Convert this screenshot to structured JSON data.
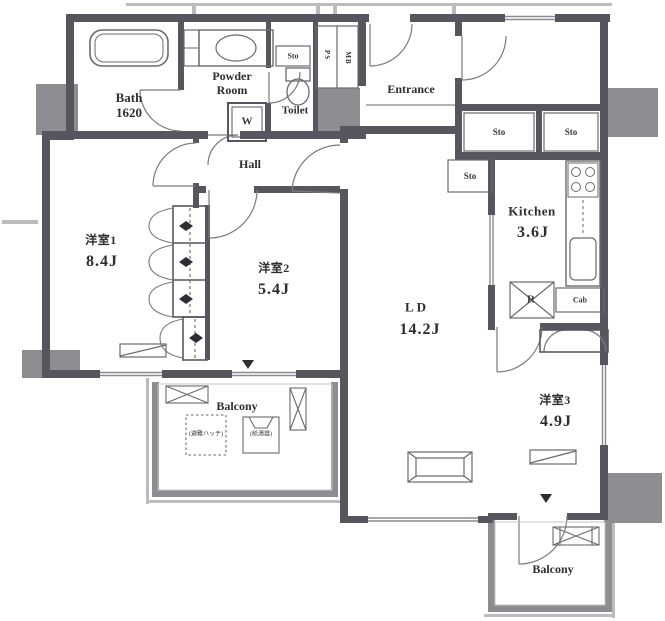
{
  "plan": {
    "type_note": "apartment-floor-plan"
  },
  "colors": {
    "wall": "#56565e",
    "column": "#8d8d92",
    "thin_line": "#77777e",
    "light_line": "#bcbcc0",
    "text": "#2d2d33",
    "floor": "#ffffff"
  },
  "rooms": {
    "bath": {
      "label": "Bath",
      "size": "1620"
    },
    "powder_room": {
      "label": "Powder Room"
    },
    "toilet": {
      "label": "Toilet"
    },
    "entrance": {
      "label": "Entrance"
    },
    "hall": {
      "label": "Hall"
    },
    "kitchen": {
      "label": "Kitchen",
      "size": "3.6J"
    },
    "living_dining": {
      "label": "LD",
      "size": "14.2J"
    },
    "bedroom1": {
      "label": "洋室1",
      "size": "8.4J"
    },
    "bedroom2": {
      "label": "洋室2",
      "size": "5.4J"
    },
    "bedroom3": {
      "label": "洋室3",
      "size": "4.9J"
    },
    "balcony_south": {
      "label": "Balcony"
    },
    "balcony_east": {
      "label": "Balcony"
    }
  },
  "fixtures": {
    "washer": "W",
    "refrigerator": "R",
    "cabinet": "Cab",
    "storage_toilet": "Sto",
    "storage_corridor_1": "Sto",
    "storage_corridor_2": "Sto",
    "storage_kitchen": "Sto",
    "pipe_shaft": "PS",
    "meter_box": "MB",
    "balcony_hatch": "(避難ハッチ)",
    "water_heater": "(給湯器)"
  }
}
